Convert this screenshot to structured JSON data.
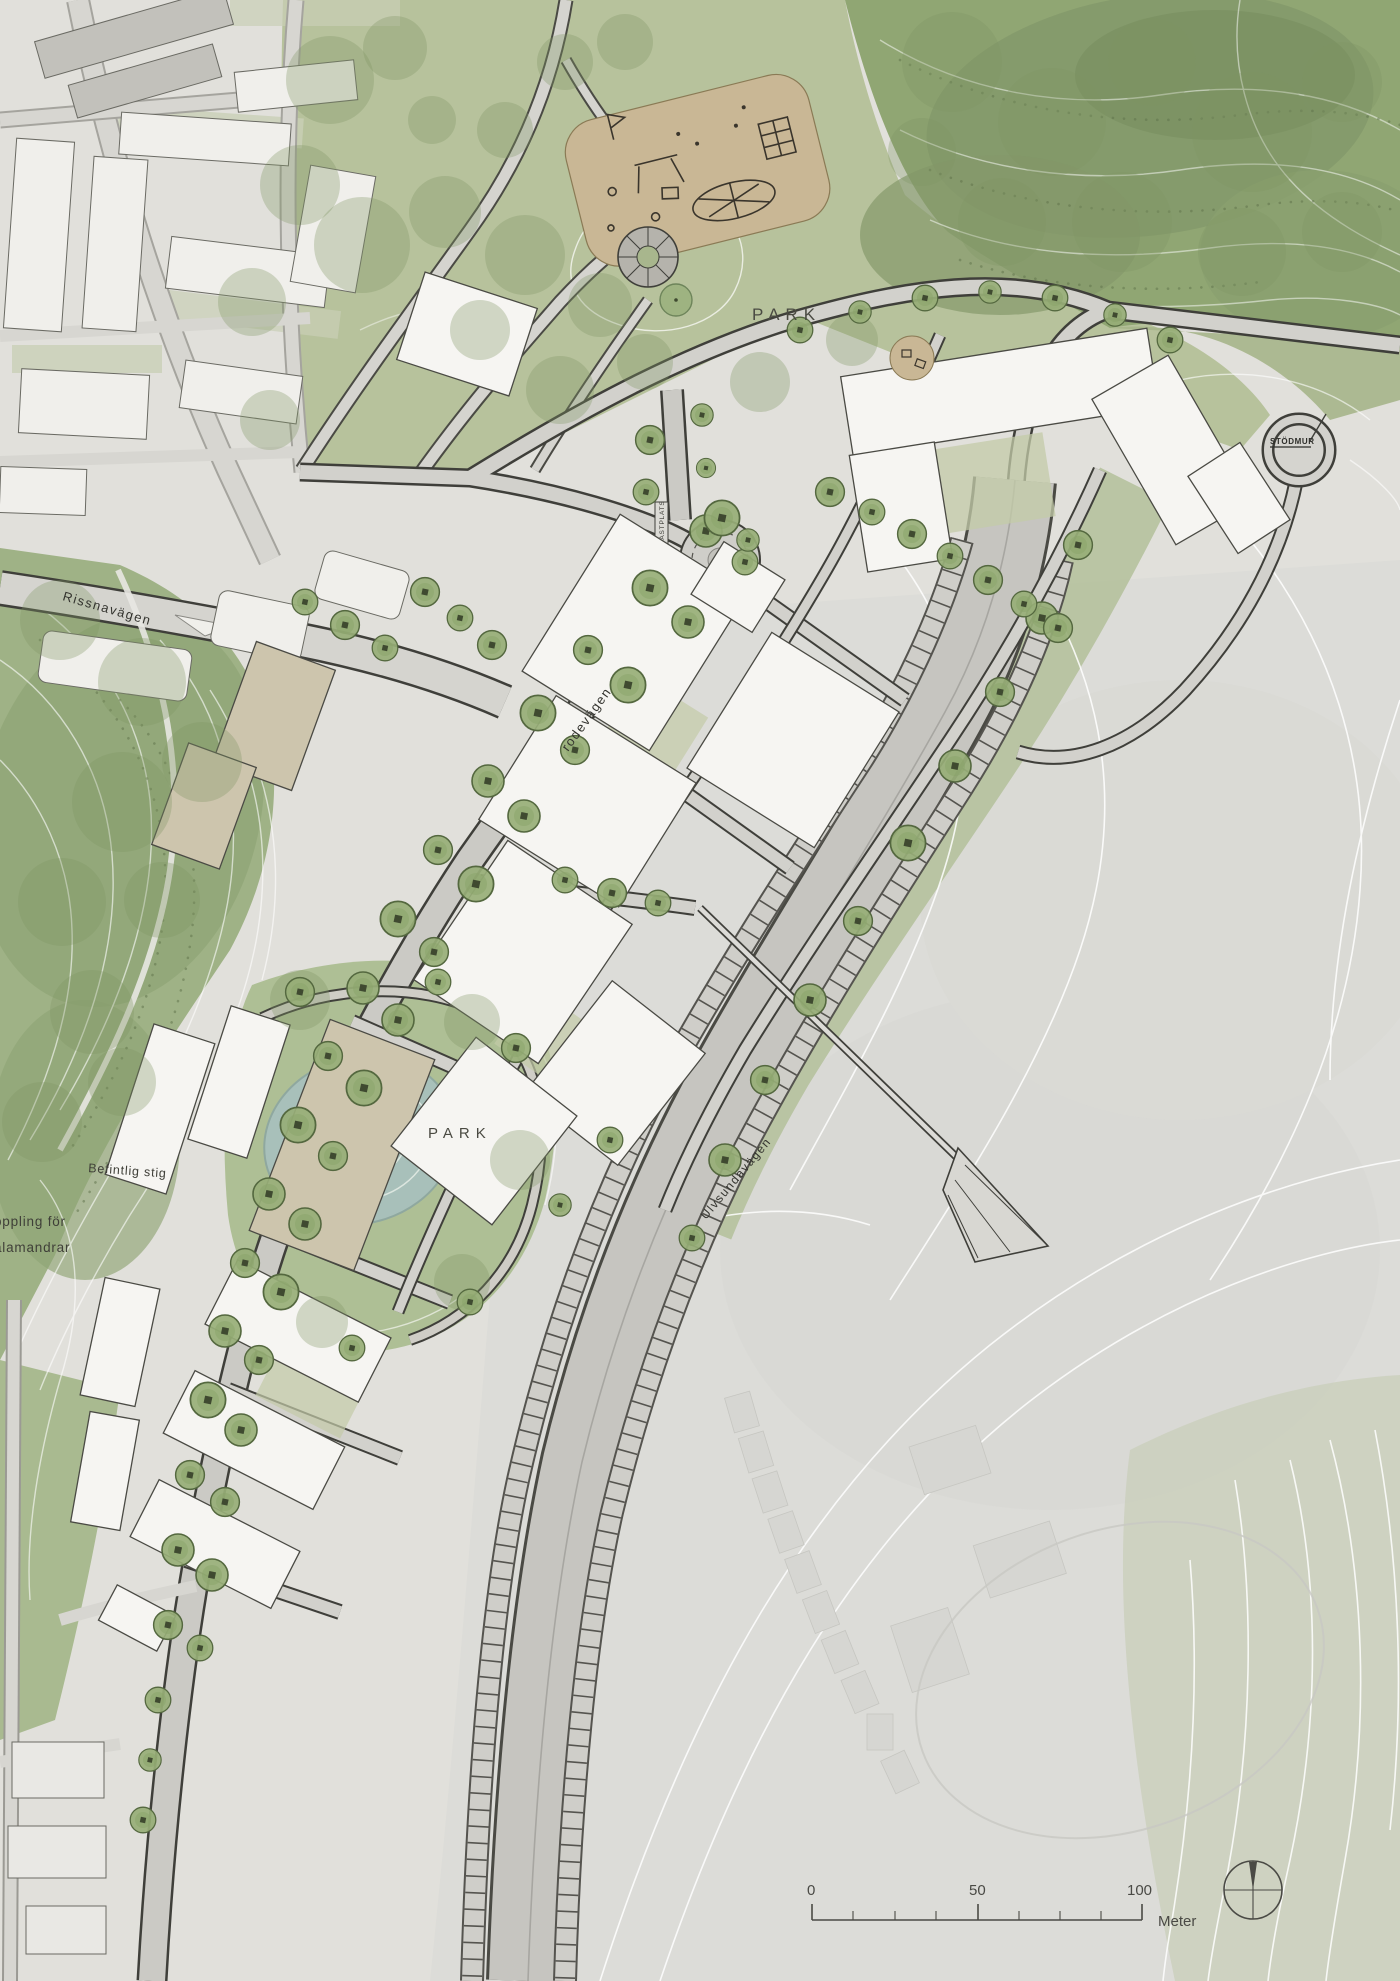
{
  "map": {
    "type": "illustrative-site-plan",
    "labels": {
      "park_top": "PARK",
      "park_pond": "PARK",
      "rissnavagen": "Rissnavägen",
      "rodevagen": "rodevägen",
      "ulvsundavagen": "Ulvsundavägen",
      "befintlig_stig": "Befintlig stig",
      "koppling_line1": "oppling för",
      "koppling_line2": "alamandrar",
      "lastplats": "LASTPLATS",
      "stodmur": "STÖDMUR"
    },
    "scalebar": {
      "tick_labels": [
        "0",
        "50",
        "100"
      ],
      "unit": "Meter"
    },
    "colors": {
      "base": "#e1e0db",
      "field": "#dcdcd8",
      "park_light": "#b7c29c",
      "park_mid": "#9fb286",
      "forest": "#90a673",
      "water": "#a8c0ba",
      "road": "#cecdc8",
      "road_edge": "#45453f",
      "building_white": "#f6f5f2",
      "building_tan": "#cdc5ad",
      "tree_fill": "#97ae77",
      "tree_edge": "#54683f",
      "playground": "#c9b795",
      "contour": "#ffffff",
      "label": "#3c3c36"
    }
  }
}
